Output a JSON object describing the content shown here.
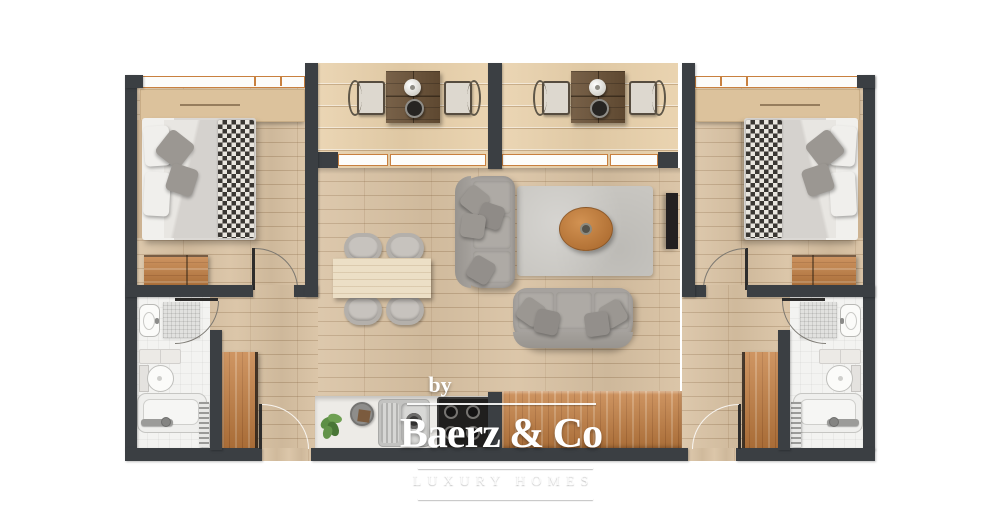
{
  "image": {
    "kind": "architectural floor plan",
    "view": "top-down 2D render",
    "unit": "holiday apartment"
  },
  "watermark": {
    "by": "by",
    "brand": "Baerz & Co",
    "tagline": "LUXURY HOMES"
  },
  "palette": {
    "wall": "#3b3f43",
    "floor_wood": "#d9c2a3",
    "balcony_wood": "#e8d0aa",
    "bathroom_tile": "#f3f3f1",
    "accent_wood_orange": "#c47e40",
    "sofa_gray": "#a6a29e",
    "rug_gray": "#c8c6c1",
    "coffee_table_wood": "#c98745",
    "window_frame": "#c8803f",
    "bistro_table_wood": "#6b5237"
  },
  "rooms": {
    "bedroom_left": {
      "name": "bedroom left",
      "furniture": [
        "double bed with checkered throw",
        "low wardrobe along window wall",
        "dresser",
        "window",
        "door"
      ]
    },
    "bedroom_right": {
      "name": "bedroom right",
      "furniture": [
        "double bed with checkered throw",
        "low wardrobe along window wall",
        "dresser",
        "window",
        "door"
      ]
    },
    "bathroom_left": {
      "name": "bathroom left",
      "fixtures": [
        "washbasin",
        "shower mat",
        "wall shelf",
        "toilet",
        "bathtub",
        "towel radiator",
        "door"
      ]
    },
    "bathroom_right": {
      "name": "bathroom right",
      "fixtures": [
        "washbasin",
        "shower mat",
        "wall shelf",
        "toilet",
        "bathtub",
        "towel radiator",
        "door"
      ]
    },
    "living_dining": {
      "name": "living / dining room",
      "furniture": [
        "three-seat sofa",
        "two-seat sofa",
        "area rug",
        "oval coffee table",
        "wall tv",
        "dining table",
        "four dining chairs"
      ]
    },
    "kitchen": {
      "name": "kitchen",
      "furniture": [
        "white counter",
        "plant",
        "round cutting board",
        "sink with faucet",
        "cooktop with 4 burners",
        "wooden counter"
      ]
    },
    "balcony_left": {
      "name": "balcony left",
      "furniture": [
        "bistro table",
        "two chairs",
        "vase",
        "bowl"
      ],
      "access": "sliding glass doors"
    },
    "balcony_right": {
      "name": "balcony right",
      "furniture": [
        "bistro table",
        "two chairs",
        "vase",
        "bowl"
      ],
      "access": "sliding glass doors"
    },
    "entrances": {
      "doors": [
        "entry door left",
        "entry door right"
      ]
    },
    "hallways": {
      "closets": [
        "tall wardrobe left",
        "tall wardrobe right"
      ]
    }
  }
}
